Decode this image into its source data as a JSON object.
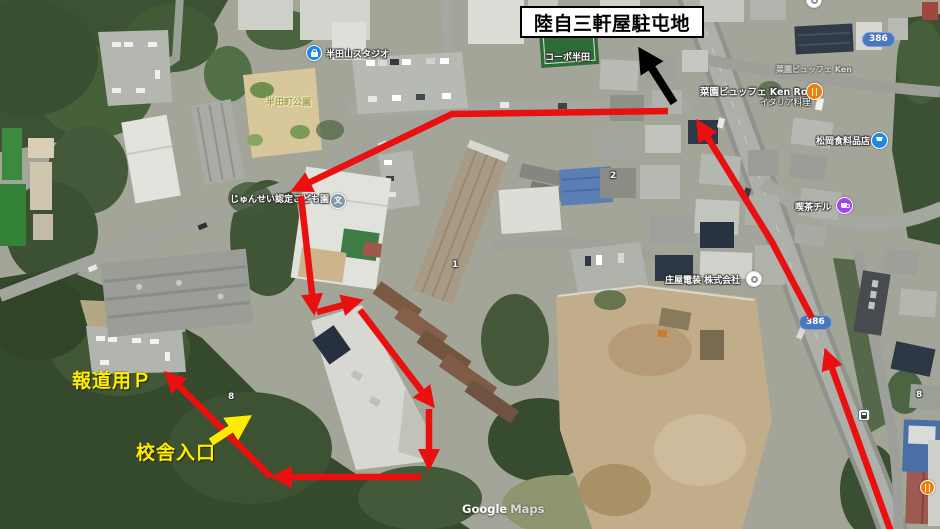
{
  "title_box": {
    "label": "陸自三軒屋駐屯地"
  },
  "annotations": {
    "press_parking": "報道用Ｐ",
    "building_entrance": "校舎入口",
    "colors": {
      "route_arrow": "#ea1010",
      "camp_arrow": "#000000",
      "entrance_arrow": "#ffec00",
      "title_border": "#000000"
    }
  },
  "map_labels": {
    "coopo_handa": "コーポ半田",
    "handayama_studio": "半田山スタジオ",
    "handacho_park": "半田町公園",
    "junsei_kodomoen": "じゅんせい認定こども園",
    "saien_buffet_dup": "菜園ビュッフェ Ken",
    "saien_buffet": "菜園ビュッフェ Ken Roku",
    "saien_buffet_sub": "イタリア料理",
    "matsuoka_grocery": "松岡食料品店",
    "kissa_chiru": "喫茶チル",
    "shoya_denso": "庄屋電装 株式会社",
    "route_386_a": "386",
    "route_386_b": "386",
    "bldg_no_2": "2",
    "bldg_no_1": "1",
    "bldg_no_8a": "8",
    "bldg_no_8b": "8"
  },
  "icons": {
    "school_glyph": "文"
  },
  "watermark": {
    "word1": "Google",
    "word2": "Maps"
  }
}
